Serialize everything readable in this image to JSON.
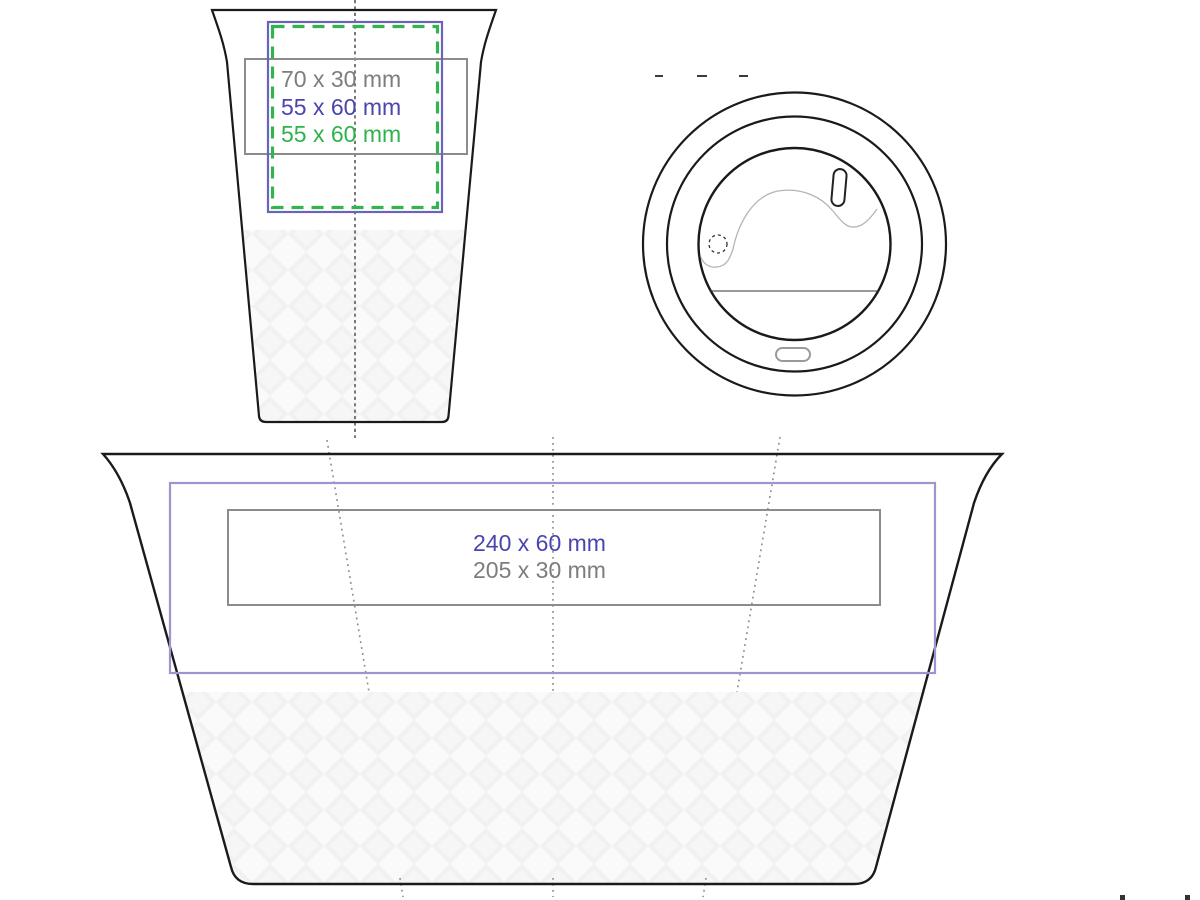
{
  "front_view": {
    "labels": [
      {
        "text": "70 x 30 mm",
        "color": "#7d7d7d"
      },
      {
        "text": "55 x 60 mm",
        "color": "#4a44ad"
      },
      {
        "text": "55 x 60 mm",
        "color": "#2eb34c"
      }
    ]
  },
  "flat_view": {
    "labels": [
      {
        "text": "240 x 60 mm",
        "color": "#4a44ad"
      },
      {
        "text": "205 x 30 mm",
        "color": "#7d7d7d"
      }
    ]
  },
  "colors": {
    "outline": "#1a1a1a",
    "front_blue_frame": "#6c63b8",
    "flat_blue_frame": "#9a96d2",
    "green_frame": "#33b44f",
    "gray_frame": "#8c8c8c",
    "guide": "#8a8a8a",
    "lid_detail": "#b5b5b5"
  }
}
